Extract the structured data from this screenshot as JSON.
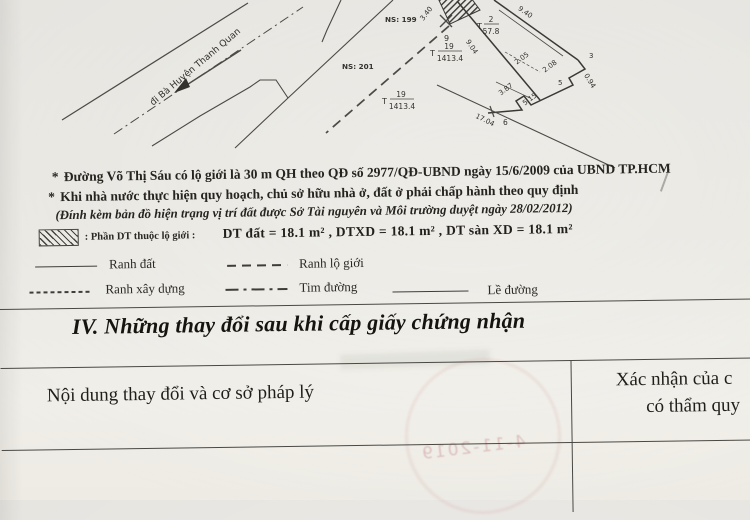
{
  "drawing": {
    "road_label": "đi Bà Huyện Thanh Quan",
    "house_199": "NS: 199",
    "house_201": "NS: 201",
    "marker_point": "9",
    "frac_t19_prefix": "T",
    "frac_t19_num": "19",
    "frac_t19_den": "1413.4",
    "frac_t2_prefix": "T",
    "frac_t2_num": "2",
    "frac_t2_den": "57.8",
    "dim_3_40": "3.40",
    "dim_9_40": "9.40",
    "dim_9_04": "9.04",
    "dim_2_05": "2.05",
    "dim_2_08": "2.08",
    "dim_0_94": "0.94",
    "dim_3_87": "3.87",
    "dim_5_15": "5.15",
    "dim_17_04": "17.04",
    "node_3": "3",
    "node_5": "5",
    "node_6": "6"
  },
  "notes": {
    "marker": "*",
    "line1": "Đường Võ Thị Sáu có lộ giới là 30 m QH theo QĐ số 2977/QĐ-UBND ngày 15/6/2009 của UBND TP.HCM",
    "line2": "Khi nhà nước thực hiện quy hoạch, chủ sở hữu nhà ở, đất ở phải chấp hành theo quy định",
    "line3": "(Đính kèm bản đồ hiện trạng vị trí đất được Sở Tài nguyên và Môi trường duyệt ngày 28/02/2012)"
  },
  "hatch_note": {
    "label": ": Phần DT thuộc lộ giới :",
    "values": "DT đất = 18.1 m² , DTXD = 18.1 m² , DT sàn XD = 18.1 m²"
  },
  "legend": {
    "ranh_dat": "Ranh đất",
    "ranh_lo_gioi": "Ranh lộ giới",
    "ranh_xay_dung": "Ranh xây dựng",
    "tim_duong": "Tim đường",
    "le_duong": "Lề đường"
  },
  "section_iv": {
    "heading": "IV. Những thay đổi sau khi cấp giấy chứng nhận"
  },
  "table": {
    "col1_header": "Nội dung thay đổi và cơ sở pháp lý",
    "col2_header_line1": "Xác nhận của c",
    "col2_header_line2": "có thẩm quy"
  },
  "stamp_bleed": {
    "digits": "4-11-2019"
  },
  "colors": {
    "paper": "#e9e7e2",
    "ink": "#26241f",
    "line": "#46443f",
    "stamp_pink": "#ba6c76"
  }
}
